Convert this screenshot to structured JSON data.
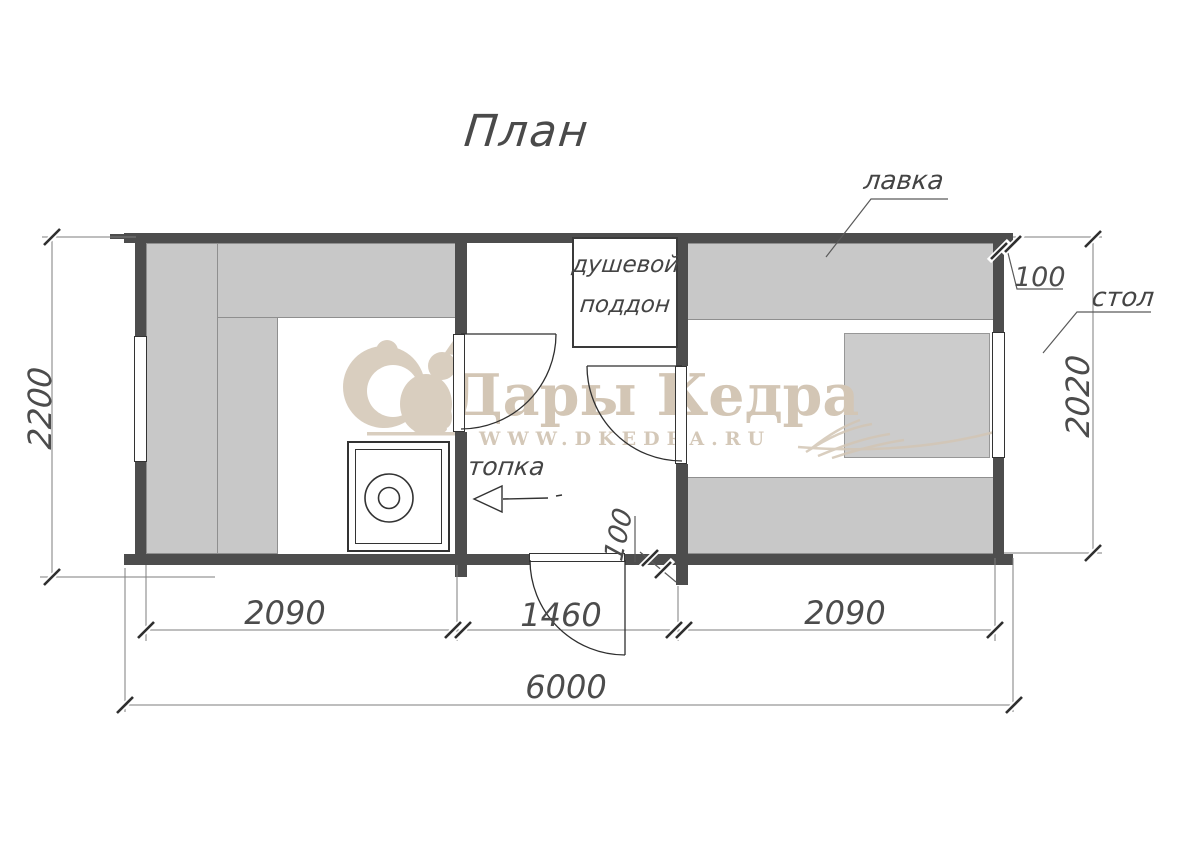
{
  "title": "План",
  "watermark": {
    "brand": "Дары Кедра",
    "site": "WWW.DKEDRA.RU"
  },
  "labels": {
    "bench": "лавка",
    "table": "стол",
    "shower_tray": [
      "душевой",
      "поддон"
    ],
    "firebox": "топка"
  },
  "dimensions": {
    "total_length": "6000",
    "left_room_width": "2090",
    "middle_room_width": "1460",
    "right_room_width": "2090",
    "left_height": "2200",
    "right_height": "2020",
    "wall_thickness_right": "100",
    "wall_thickness_door": "100"
  },
  "colors": {
    "wall": "#4d4d4d",
    "bench_fill": "#c8c8c8",
    "line": "#2f2f2f",
    "dimension_line": "#7d7d7d",
    "watermark": "#d3c6b5",
    "background": "#ffffff"
  }
}
